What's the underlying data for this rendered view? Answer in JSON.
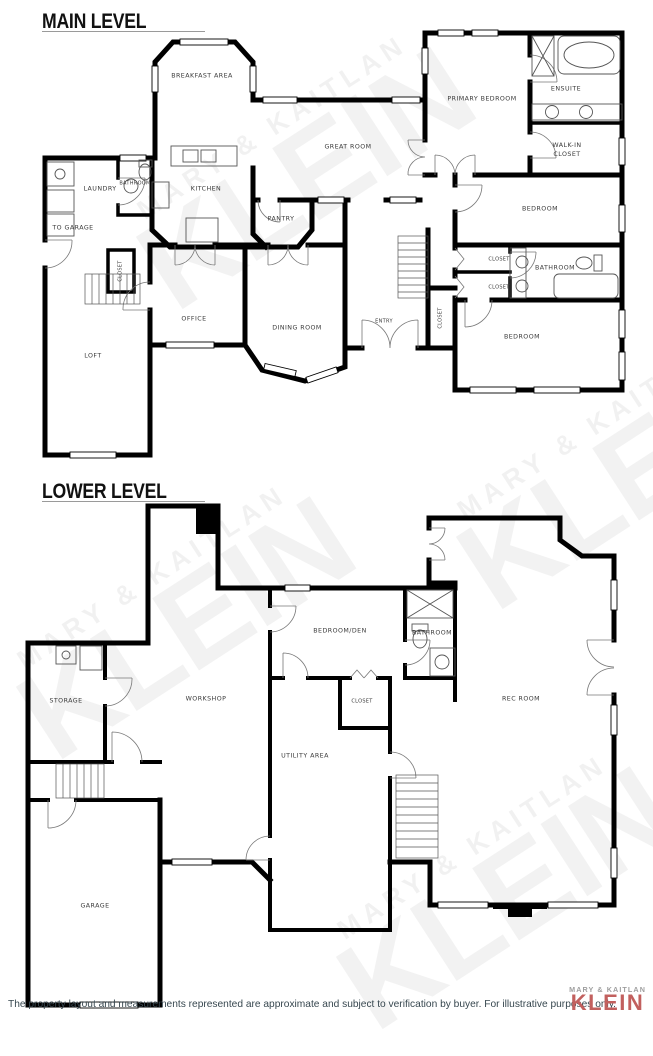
{
  "watermark": {
    "line1": "MARY & KAITLAN",
    "line2": "KLEIN"
  },
  "colors": {
    "brand": "#c2605e",
    "wall": "#000000",
    "disclaimer_text": "#37474f"
  },
  "levels": [
    {
      "title": "MAIN LEVEL",
      "rooms": [
        {
          "id": "breakfast-area",
          "label": "BREAKFAST AREA",
          "x": 202,
          "y": 77
        },
        {
          "id": "great-room",
          "label": "GREAT ROOM",
          "x": 348,
          "y": 148
        },
        {
          "id": "primary-bedroom",
          "label": "PRIMARY BEDROOM",
          "x": 482,
          "y": 100
        },
        {
          "id": "ensuite",
          "label": "ENSUITE",
          "x": 566,
          "y": 90
        },
        {
          "id": "walk-in-closet",
          "label": "WALK-IN\nCLOSET",
          "x": 567,
          "y": 151
        },
        {
          "id": "bedroom-ne",
          "label": "BEDROOM",
          "x": 540,
          "y": 210
        },
        {
          "id": "laundry",
          "label": "LAUNDRY",
          "x": 100,
          "y": 190
        },
        {
          "id": "bathroom-w",
          "label": "BATHROOM",
          "x": 135,
          "y": 184,
          "small": true
        },
        {
          "id": "kitchen",
          "label": "KITCHEN",
          "x": 206,
          "y": 190
        },
        {
          "id": "pantry",
          "label": "PANTRY",
          "x": 281,
          "y": 220
        },
        {
          "id": "to-garage",
          "label": "TO GARAGE",
          "x": 73,
          "y": 229
        },
        {
          "id": "closet-w",
          "label": "CLOSET",
          "x": 121,
          "y": 271,
          "small": true,
          "vertical": true
        },
        {
          "id": "office",
          "label": "OFFICE",
          "x": 194,
          "y": 320
        },
        {
          "id": "dining-room",
          "label": "DINING ROOM",
          "x": 297,
          "y": 329
        },
        {
          "id": "loft",
          "label": "LOFT",
          "x": 93,
          "y": 357
        },
        {
          "id": "entry",
          "label": "ENTRY",
          "x": 384,
          "y": 322,
          "small": true
        },
        {
          "id": "closet-center",
          "label": "CLOSET",
          "x": 441,
          "y": 318,
          "small": true,
          "vertical": true
        },
        {
          "id": "closet-r1",
          "label": "CLOSET",
          "x": 499,
          "y": 260,
          "small": true
        },
        {
          "id": "closet-r2",
          "label": "CLOSET",
          "x": 499,
          "y": 288,
          "small": true
        },
        {
          "id": "bathroom-e",
          "label": "BATHROOM",
          "x": 555,
          "y": 269
        },
        {
          "id": "bedroom-se",
          "label": "BEDROOM",
          "x": 522,
          "y": 338
        }
      ]
    },
    {
      "title": "LOWER LEVEL",
      "rooms": [
        {
          "id": "storage",
          "label": "STORAGE",
          "x": 66,
          "y": 702
        },
        {
          "id": "workshop",
          "label": "WORKSHOP",
          "x": 206,
          "y": 700
        },
        {
          "id": "bedroom-den",
          "label": "BEDROOM/DEN",
          "x": 340,
          "y": 632
        },
        {
          "id": "bathroom-lower",
          "label": "BATHROOM",
          "x": 432,
          "y": 634
        },
        {
          "id": "closet-lower",
          "label": "CLOSET",
          "x": 362,
          "y": 702,
          "small": true
        },
        {
          "id": "rec-room",
          "label": "REC ROOM",
          "x": 521,
          "y": 700
        },
        {
          "id": "utility-area",
          "label": "UTILITY AREA",
          "x": 305,
          "y": 757
        },
        {
          "id": "garage",
          "label": "GARAGE",
          "x": 95,
          "y": 907
        }
      ]
    }
  ],
  "footer": {
    "disclaimer": "The property layout and measurements represented are approximate and subject to verification by buyer. For illustrative purposes only.",
    "brand_top": "MARY & KAITLAN",
    "brand_name": "KLEIN"
  }
}
